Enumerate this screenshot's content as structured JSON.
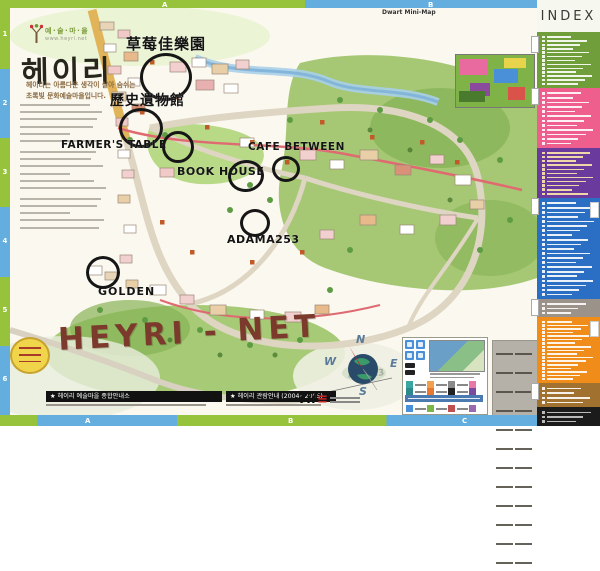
{
  "branding": {
    "village_label": "예·술·마·을",
    "site_url": "www.heyri.net",
    "main_title": "헤이리",
    "tagline_line1": "헤이리는 아름다운 생각이 살아 숨쉬는",
    "tagline_line2": "초록빛 문화예술마을입니다."
  },
  "grid": {
    "left_numbers": [
      "1",
      "2",
      "3",
      "4",
      "5",
      "6"
    ],
    "top_letters": [
      "A",
      "B"
    ],
    "bottom_letters": [
      "A",
      "B",
      "C"
    ]
  },
  "minimap": {
    "label": "Dwart Mini-Map"
  },
  "annotations": {
    "items": [
      {
        "text": "草莓佳樂園"
      },
      {
        "text": "歷史遺物館"
      },
      {
        "text": "FARMER'S TABLE"
      },
      {
        "text": "BOOK HOUSE"
      },
      {
        "text": "CAFE BETWEEN"
      },
      {
        "text": "ADAMA253"
      },
      {
        "text": "GOLDEN"
      },
      {
        "text": "HEYRI - NET"
      },
      {
        "text": "4-4+13"
      }
    ]
  },
  "compass": {
    "north": "N",
    "east": "E",
    "south": "S",
    "west": "W"
  },
  "index_panel": {
    "title": "INDEX",
    "sections": [
      {
        "id": "green",
        "color": "#6f9e3a",
        "text_color": "#ffffff",
        "rows": 13
      },
      {
        "id": "pink",
        "color": "#ef5f8e",
        "text_color": "#ffffff",
        "rows": 12
      },
      {
        "id": "purple",
        "color": "#6a3b9c",
        "text_color": "#ffe9a8",
        "rows": 11
      },
      {
        "id": "blue",
        "color": "#2b6fc4",
        "text_color": "#ffffff",
        "rows": 21
      },
      {
        "id": "gray",
        "color": "#9b9389",
        "text_color": "#ffffff",
        "rows": 3
      },
      {
        "id": "orange",
        "color": "#ef8c1a",
        "text_color": "#ffffff",
        "rows": 17
      },
      {
        "id": "brown",
        "color": "#a1722f",
        "text_color": "#ffffff",
        "rows": 4
      },
      {
        "id": "black",
        "color": "#1b1b1b",
        "text_color": "#cccccc",
        "rows": 3
      }
    ]
  },
  "footer": {
    "bar1": "★ 헤이리 예술마을 종합안내소",
    "bar2": "★ 헤이리 관람안내 (2004~2005)",
    "logo_text": "Tif"
  }
}
